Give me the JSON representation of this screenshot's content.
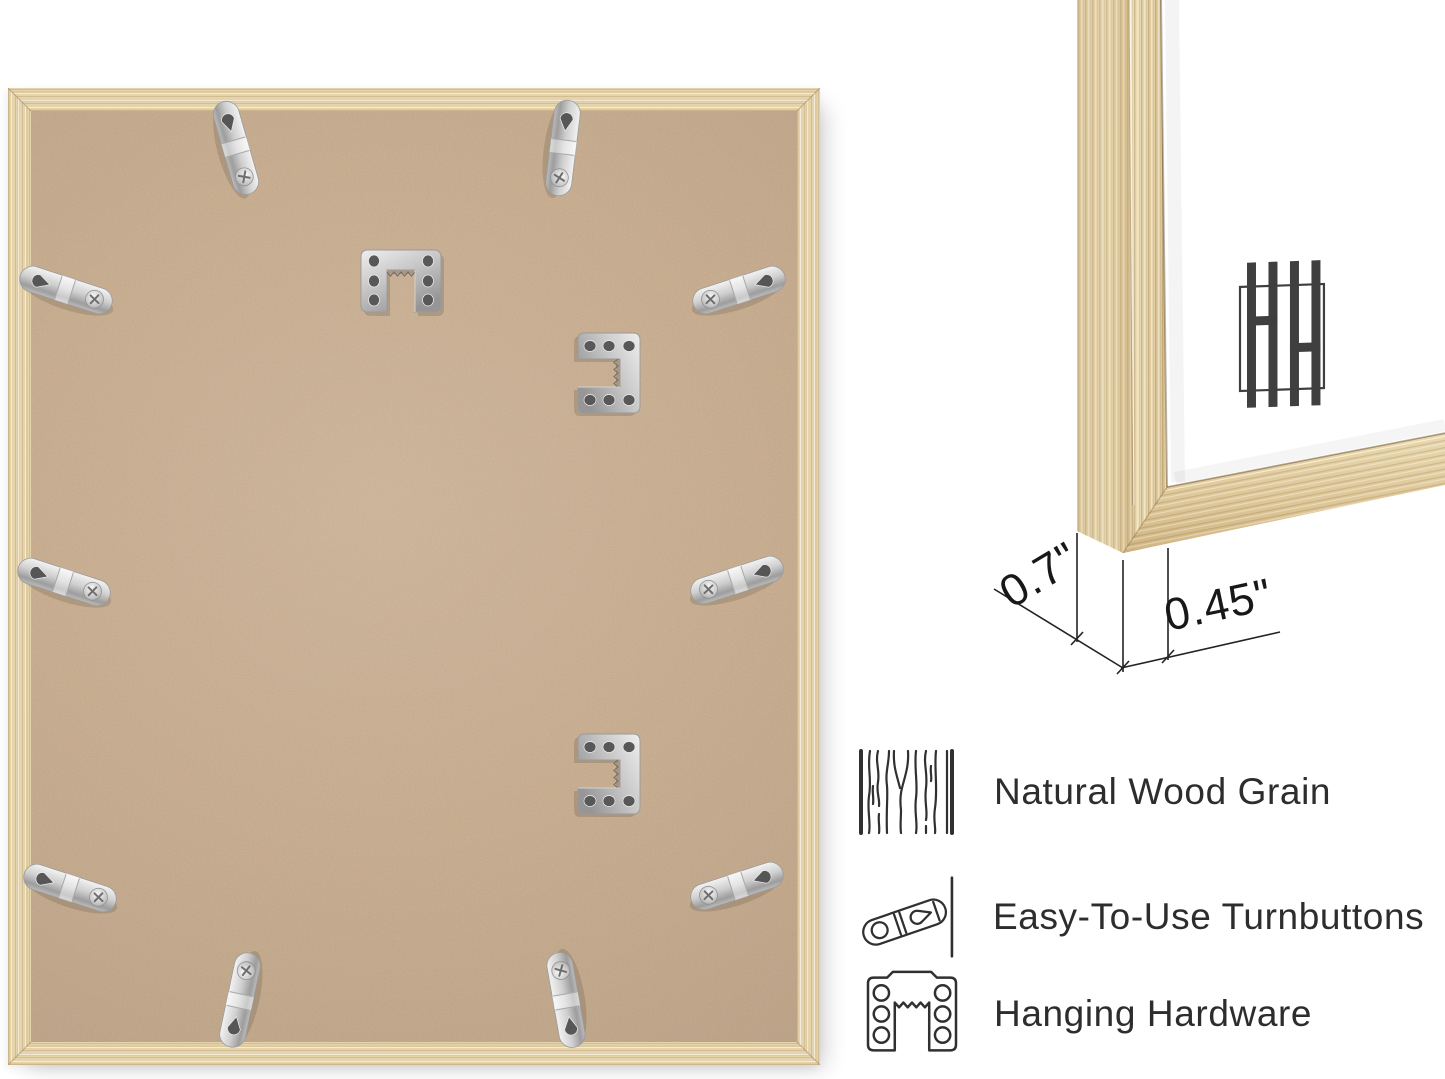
{
  "dimensions": {
    "depth_label": "0.7\"",
    "face_width_label": "0.45\""
  },
  "features": [
    {
      "icon": "wood-grain-icon",
      "label": "Natural Wood Grain"
    },
    {
      "icon": "turnbutton-icon",
      "label": "Easy-To-Use Turnbuttons"
    },
    {
      "icon": "hanging-hardware-icon",
      "label": "Hanging Hardware"
    }
  ],
  "logo": {
    "monogram": "HH"
  },
  "colors": {
    "background": "#ffffff",
    "frame_wood": "#e4d3ab",
    "wood_grain_dark": "#c7a671",
    "mdf_board": "#c7aa8b",
    "metal_hardware": "#cccccc",
    "ink": "#2d2d2d",
    "logo_gray": "#3f3f3f"
  }
}
